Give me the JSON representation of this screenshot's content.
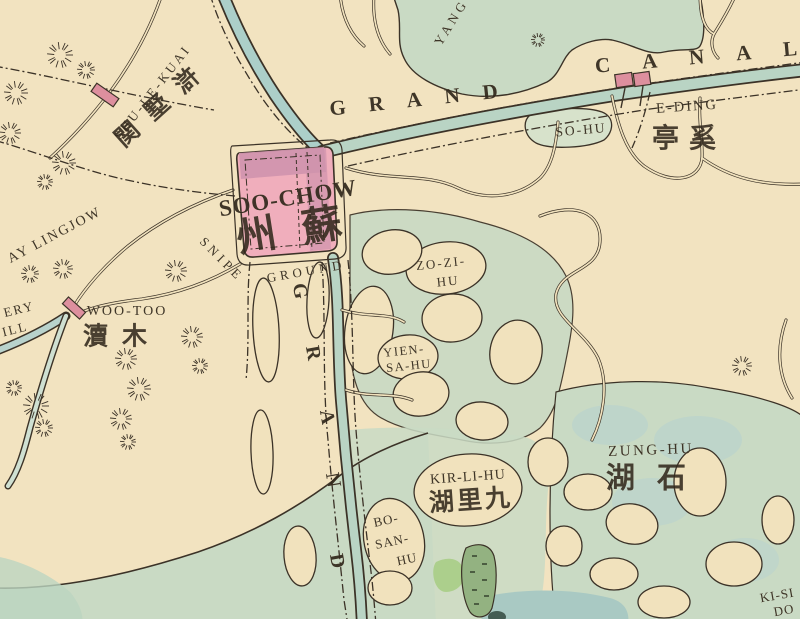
{
  "map": {
    "kind": "vintage-city-map",
    "colors": {
      "paper": "#f1e2bd",
      "paper_warm": "#f4e6c6",
      "ink": "#32291d",
      "line": "#3b3227",
      "lake": "#c9dac4",
      "lake_blue": "#b7d2cf",
      "canal": "#b9d4c4",
      "canal_blue": "#accfc9",
      "deep_water": "#a9c9c3",
      "city_fill": "#f0aebc",
      "city_dark": "#cf93ad",
      "town_fill": "#dd8f9e",
      "marsh": "#93b281",
      "marsh_bright": "#a6cd83"
    }
  },
  "labels": [
    {
      "name": "label-shu-le-kuai",
      "text": "SHU-LE-KUAI",
      "x": 152,
      "y": 92,
      "rot": -52,
      "size": 13,
      "ls": 3
    },
    {
      "name": "label-hushuguan-cn",
      "text": "関墅滸",
      "x": 163,
      "y": 102,
      "rot": -42,
      "size": 24,
      "ls": 16,
      "cls": "cn"
    },
    {
      "name": "label-grand-canal-word-grand",
      "text": "GRAND",
      "x": 425,
      "y": 99,
      "rot": -6,
      "size": 21,
      "ls": 23,
      "weight": 700
    },
    {
      "name": "label-grand-canal-word-canal",
      "text": "CANAL",
      "x": 712,
      "y": 56,
      "rot": -5,
      "size": 21,
      "ls": 32,
      "weight": 700
    },
    {
      "name": "label-yang-lake",
      "text": "YANG",
      "x": 451,
      "y": 22,
      "rot": -58,
      "size": 13,
      "ls": 4
    },
    {
      "name": "label-soochow",
      "text": "SOO-CHOW",
      "x": 288,
      "y": 198,
      "rot": -9,
      "size": 23,
      "ls": 1,
      "weight": 700
    },
    {
      "name": "label-soochow-cn",
      "text": "州蘇",
      "x": 302,
      "y": 229,
      "rot": -9,
      "size": 40,
      "ls": 26,
      "cls": "cn"
    },
    {
      "name": "label-snipe",
      "text": "SNIPE",
      "x": 222,
      "y": 259,
      "rot": 45,
      "size": 13,
      "ls": 4
    },
    {
      "name": "label-ground",
      "text": "GROUND",
      "x": 306,
      "y": 271,
      "rot": -10,
      "size": 13,
      "ls": 4
    },
    {
      "name": "label-grand-vertical-g",
      "text": "G",
      "x": 300,
      "y": 291,
      "rot": 80,
      "size": 20,
      "weight": 700
    },
    {
      "name": "label-grand-vertical-r",
      "text": "R",
      "x": 313,
      "y": 353,
      "rot": 80,
      "size": 20,
      "weight": 700
    },
    {
      "name": "label-grand-vertical-a",
      "text": "A",
      "x": 327,
      "y": 417,
      "rot": 80,
      "size": 20,
      "weight": 700
    },
    {
      "name": "label-grand-vertical-n",
      "text": "N",
      "x": 333,
      "y": 480,
      "rot": 80,
      "size": 20,
      "weight": 700
    },
    {
      "name": "label-grand-vertical-d",
      "text": "D",
      "x": 337,
      "y": 561,
      "rot": 80,
      "size": 20,
      "weight": 700
    },
    {
      "name": "label-zo-zi-hu-line1",
      "text": "ZO-ZI-",
      "x": 441,
      "y": 263,
      "rot": -6,
      "size": 13,
      "ls": 2
    },
    {
      "name": "label-zo-zi-hu-line2",
      "text": "HU",
      "x": 448,
      "y": 281,
      "rot": -6,
      "size": 13,
      "ls": 2
    },
    {
      "name": "label-yien-sa-hu-line1",
      "text": "YIEN-",
      "x": 404,
      "y": 351,
      "rot": -6,
      "size": 12.5,
      "ls": 1.5
    },
    {
      "name": "label-yien-sa-hu-line2",
      "text": "SA-HU",
      "x": 409,
      "y": 366,
      "rot": -6,
      "size": 12.5,
      "ls": 1.5
    },
    {
      "name": "label-so-hu",
      "text": "SO-HU",
      "x": 581,
      "y": 130,
      "rot": -5,
      "size": 13.5,
      "ls": 2
    },
    {
      "name": "label-e-ding",
      "text": "E-DING",
      "x": 687,
      "y": 107,
      "rot": -4,
      "size": 14.5,
      "ls": 2
    },
    {
      "name": "label-e-ding-cn",
      "text": "亭奚",
      "x": 689,
      "y": 139,
      "rot": 0,
      "size": 27,
      "ls": 10,
      "cls": "cn"
    },
    {
      "name": "label-woo-too",
      "text": "WOO-TOO",
      "x": 127,
      "y": 312,
      "rot": 0,
      "size": 14,
      "ls": 2
    },
    {
      "name": "label-woo-too-cn",
      "text": "瀆木",
      "x": 122,
      "y": 336,
      "rot": 0,
      "size": 25,
      "ls": 14,
      "cls": "cn"
    },
    {
      "name": "label-ay-lingjow",
      "text": "AY LINGJOW",
      "x": 55,
      "y": 236,
      "rot": -28,
      "size": 14,
      "ls": 2
    },
    {
      "name": "label-ery",
      "text": "ERY",
      "x": 19,
      "y": 309,
      "rot": -14,
      "size": 13,
      "ls": 2
    },
    {
      "name": "label-ill",
      "text": "ILL",
      "x": 15,
      "y": 329,
      "rot": -14,
      "size": 13,
      "ls": 2
    },
    {
      "name": "label-kir-li-hu",
      "text": "KIR-LI-HU",
      "x": 468,
      "y": 478,
      "rot": -4,
      "size": 14,
      "ls": 1
    },
    {
      "name": "label-kir-li-hu-cn",
      "text": "湖里九",
      "x": 471,
      "y": 500,
      "rot": -4,
      "size": 25,
      "ls": 3,
      "cls": "cn"
    },
    {
      "name": "label-bo-san-hu-line1",
      "text": "BO-",
      "x": 386,
      "y": 520,
      "rot": -12,
      "size": 13,
      "ls": 1
    },
    {
      "name": "label-bo-san-hu-line2",
      "text": "SAN-",
      "x": 392,
      "y": 541,
      "rot": -12,
      "size": 13,
      "ls": 1
    },
    {
      "name": "label-bo-san-hu-line3",
      "text": "HU",
      "x": 407,
      "y": 559,
      "rot": -12,
      "size": 13,
      "ls": 1
    },
    {
      "name": "label-zung-hu",
      "text": "ZUNG-HU",
      "x": 651,
      "y": 451,
      "rot": -2,
      "size": 15,
      "ls": 2.5
    },
    {
      "name": "label-zung-hu-cn",
      "text": "湖石",
      "x": 657,
      "y": 478,
      "rot": 0,
      "size": 29,
      "ls": 22,
      "cls": "cn"
    },
    {
      "name": "label-ki-si",
      "text": "KI-SI",
      "x": 777,
      "y": 595,
      "rot": -10,
      "size": 13,
      "ls": 1
    },
    {
      "name": "label-ki-si-line2",
      "text": "DO",
      "x": 784,
      "y": 610,
      "rot": -10,
      "size": 13,
      "ls": 1
    }
  ],
  "hills": [
    {
      "x": 60,
      "y": 55,
      "r": 13
    },
    {
      "x": 86,
      "y": 70,
      "r": 9
    },
    {
      "x": 16,
      "y": 93,
      "r": 12
    },
    {
      "x": 10,
      "y": 133,
      "r": 11
    },
    {
      "x": 64,
      "y": 163,
      "r": 12
    },
    {
      "x": 45,
      "y": 182,
      "r": 8
    },
    {
      "x": 30,
      "y": 274,
      "r": 9
    },
    {
      "x": 63,
      "y": 269,
      "r": 10
    },
    {
      "x": 176,
      "y": 271,
      "r": 11
    },
    {
      "x": 192,
      "y": 337,
      "r": 11
    },
    {
      "x": 126,
      "y": 359,
      "r": 11
    },
    {
      "x": 200,
      "y": 366,
      "r": 8
    },
    {
      "x": 36,
      "y": 406,
      "r": 13
    },
    {
      "x": 44,
      "y": 428,
      "r": 9
    },
    {
      "x": 14,
      "y": 388,
      "r": 8
    },
    {
      "x": 139,
      "y": 389,
      "r": 12
    },
    {
      "x": 121,
      "y": 419,
      "r": 11
    },
    {
      "x": 128,
      "y": 442,
      "r": 8
    },
    {
      "x": 742,
      "y": 366,
      "r": 10
    },
    {
      "x": 538,
      "y": 40,
      "r": 7
    }
  ],
  "towns": [
    {
      "name": "town-marker-hushuguan",
      "x": 105,
      "y": 95,
      "w": 10,
      "h": 27,
      "rot": -55
    },
    {
      "name": "town-marker-e-ding-west",
      "x": 624,
      "y": 80,
      "w": 17,
      "h": 13,
      "rot": -8
    },
    {
      "name": "town-marker-e-ding-east",
      "x": 642,
      "y": 79,
      "w": 16,
      "h": 13,
      "rot": -8
    },
    {
      "name": "town-marker-woo-too",
      "x": 74,
      "y": 308,
      "w": 9,
      "h": 23,
      "rot": -48
    }
  ]
}
